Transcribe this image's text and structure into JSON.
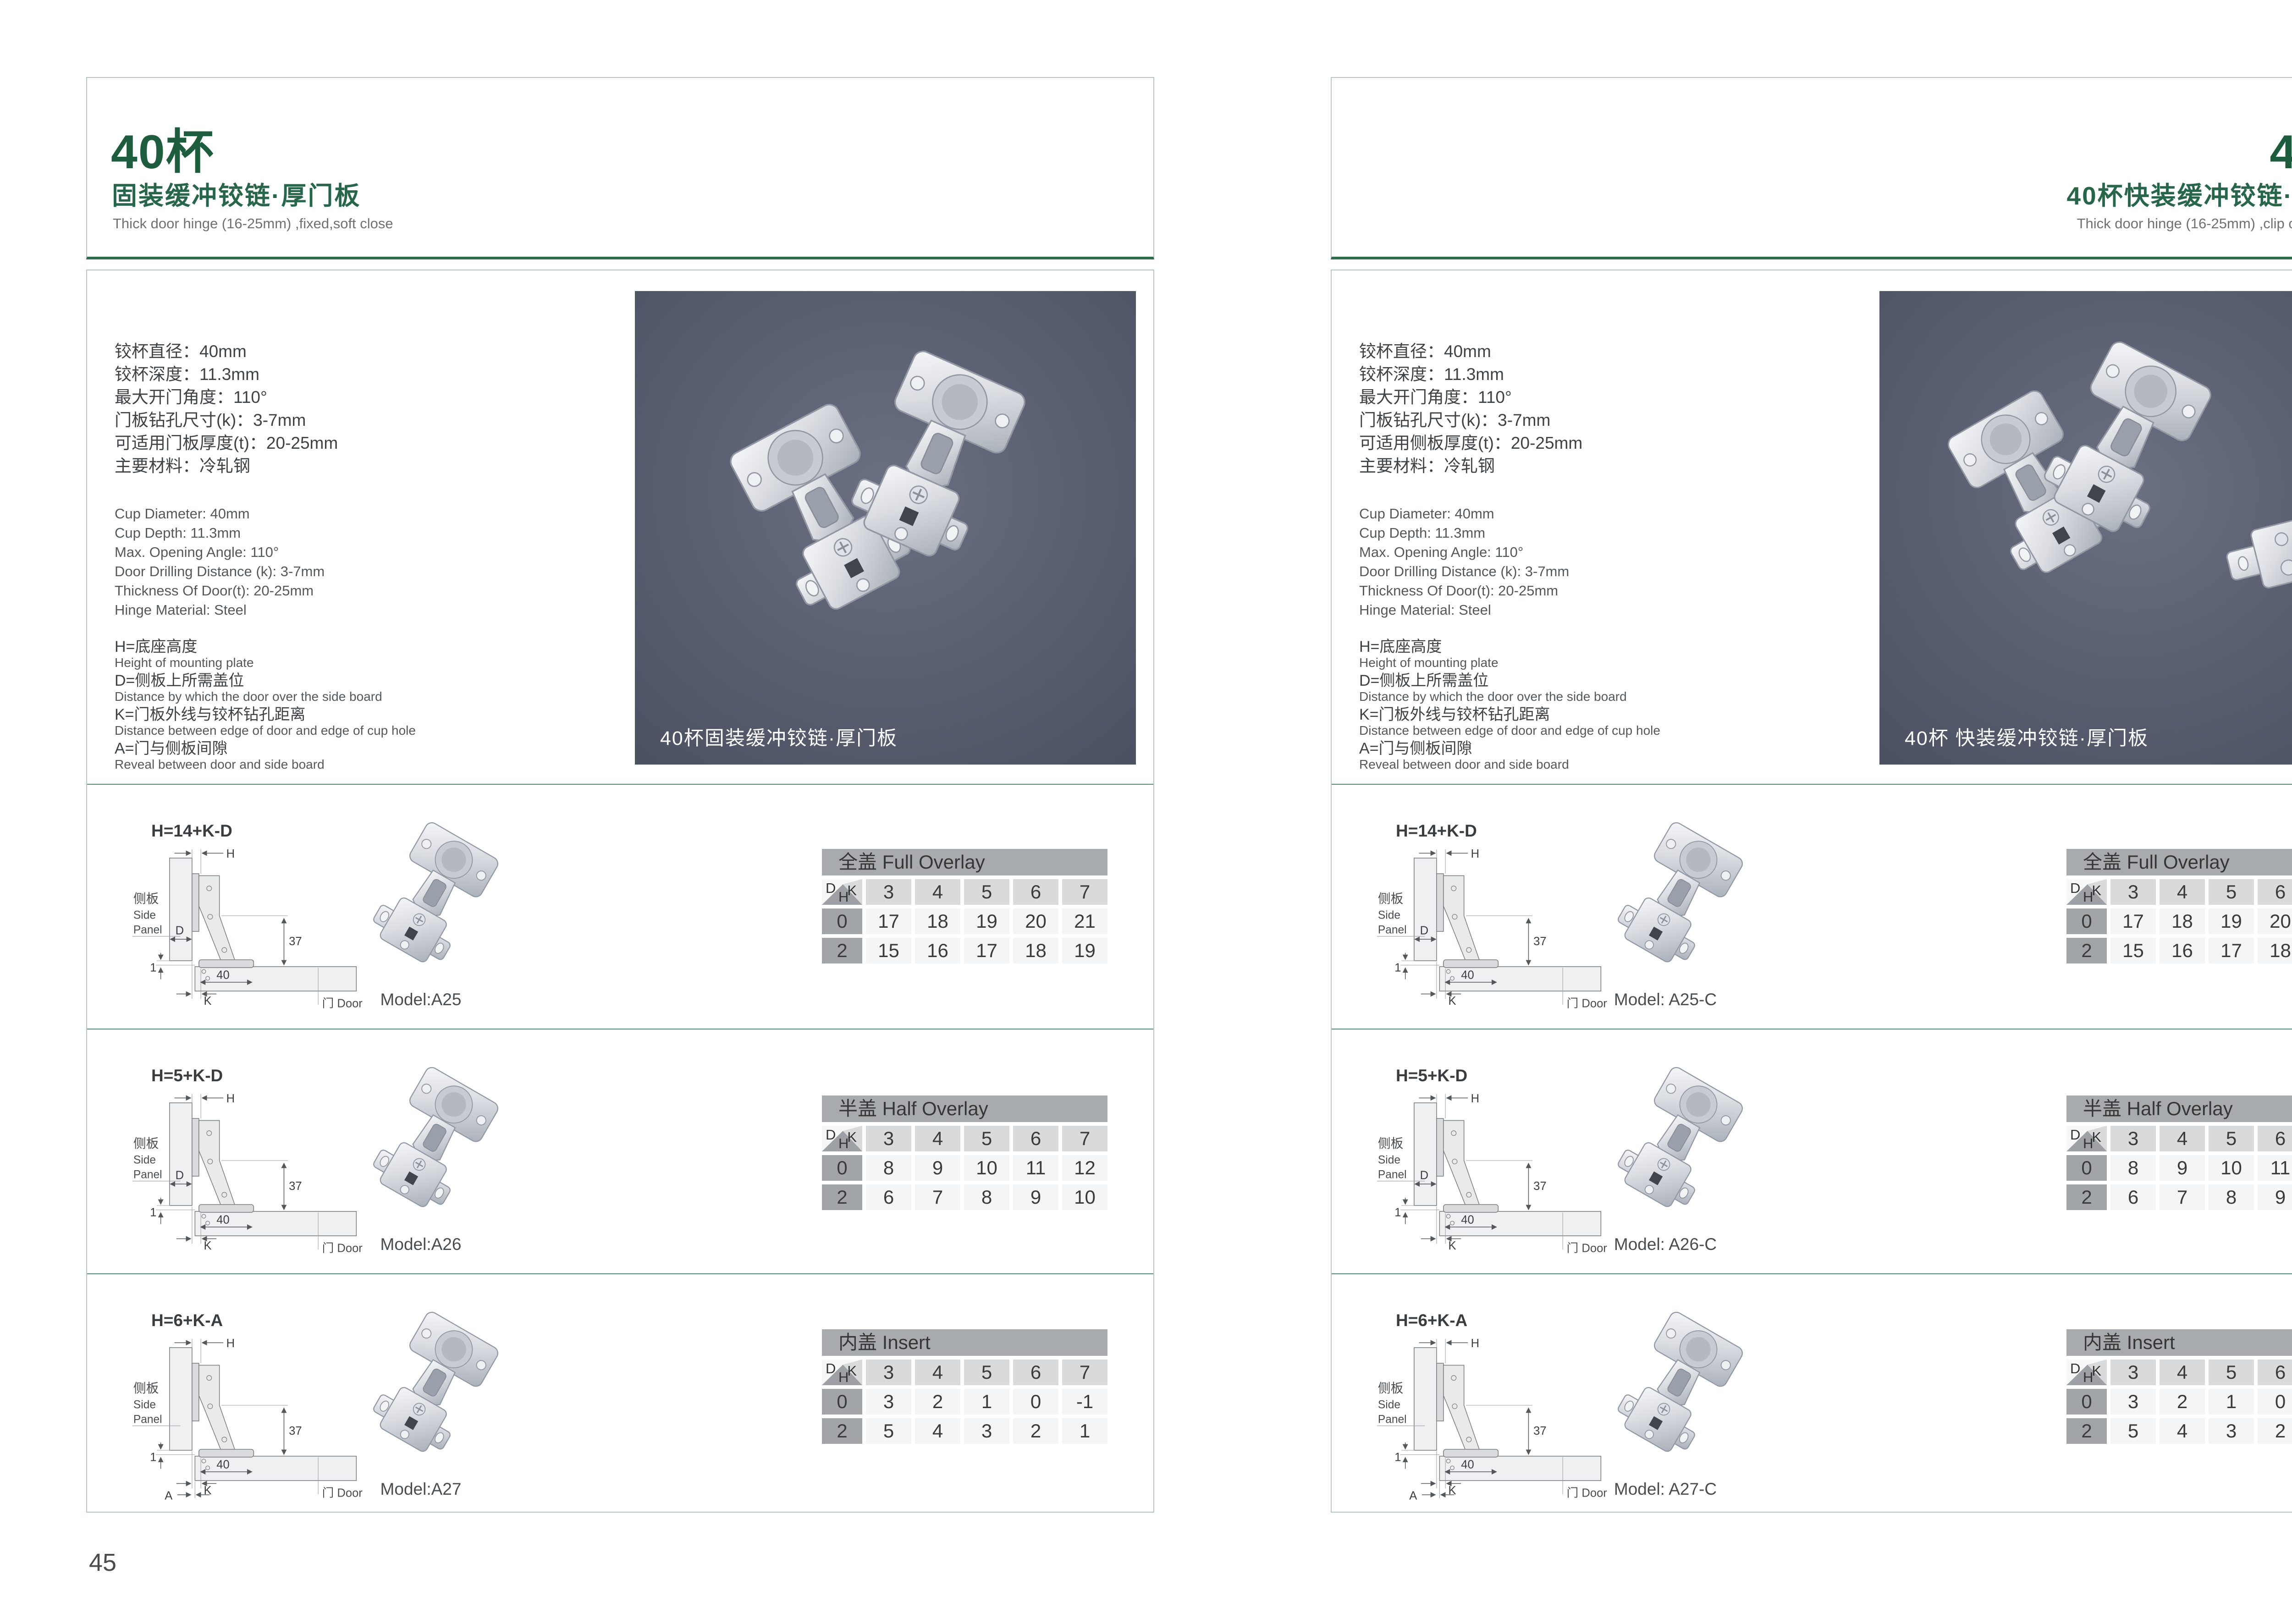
{
  "corner": {
    "d": "D",
    "k": "K",
    "h": "H"
  },
  "diagram": {
    "h": "H",
    "d": "D",
    "k": "K",
    "a": "A",
    "one": "1",
    "forty": "40",
    "thirtyseven": "37",
    "panel_zh": "侧板",
    "panel_en1": "Side",
    "panel_en2": "Panel",
    "door": "门 Door"
  },
  "colors": {
    "title_green": "#1d5c3c",
    "header_rule_green": "#2e6d4d",
    "box_border": "#b7c7bd",
    "row_separator": "#5a8b70",
    "photo_bg": "#555b6c",
    "table_title_bg": "#a8abae",
    "table_k_bg": "#d8dadb",
    "table_h_bg": "#a2a5a8",
    "table_cell_bg": "#f4f5f6"
  },
  "pages": [
    {
      "page_number": "45",
      "header": {
        "title": "40杯",
        "subtitle_zh": "固装缓冲铰链·厚门板",
        "subtitle_en": "Thick door hinge (16-25mm) ,fixed,soft close"
      },
      "specs_zh": [
        "铰杯直径：40mm",
        "铰杯深度：11.3mm",
        "最大开门角度：110°",
        "门板钻孔尺寸(k)：3-7mm",
        "可适用门板厚度(t)：20-25mm",
        "主要材料：冷轧钢"
      ],
      "specs_en": [
        "Cup Diameter: 40mm",
        "Cup Depth: 11.3mm",
        "Max. Opening Angle: 110°",
        "Door Drilling Distance (k): 3-7mm",
        "Thickness Of Door(t): 20-25mm",
        "Hinge Material: Steel"
      ],
      "legend": [
        {
          "zh": "H=底座高度",
          "en": "Height of mounting plate"
        },
        {
          "zh": "D=侧板上所需盖位",
          "en": "Distance by which the door over the side board"
        },
        {
          "zh": "K=门板外线与铰杯钻孔距离",
          "en": "Distance between edge of door and edge of cup hole"
        },
        {
          "zh": "A=门与侧板间隙",
          "en": "Reveal between door and side board"
        }
      ],
      "photo_caption": "40杯固装缓冲铰链·厚门板",
      "rows": [
        {
          "formula": "H=14+K-D",
          "variant": "d",
          "model": "Model:A25",
          "table": {
            "title": "全盖 Full Overlay",
            "k": [
              "3",
              "4",
              "5",
              "6",
              "7"
            ],
            "body": [
              {
                "h": "0",
                "v": [
                  "17",
                  "18",
                  "19",
                  "20",
                  "21"
                ]
              },
              {
                "h": "2",
                "v": [
                  "15",
                  "16",
                  "17",
                  "18",
                  "19"
                ]
              }
            ]
          }
        },
        {
          "formula": "H=5+K-D",
          "variant": "d",
          "model": "Model:A26",
          "table": {
            "title": "半盖 Half Overlay",
            "k": [
              "3",
              "4",
              "5",
              "6",
              "7"
            ],
            "body": [
              {
                "h": "0",
                "v": [
                  "8",
                  "9",
                  "10",
                  "11",
                  "12"
                ]
              },
              {
                "h": "2",
                "v": [
                  "6",
                  "7",
                  "8",
                  "9",
                  "10"
                ]
              }
            ]
          }
        },
        {
          "formula": "H=6+K-A",
          "variant": "a",
          "model": "Model:A27",
          "table": {
            "title": "内盖 Insert",
            "k": [
              "3",
              "4",
              "5",
              "6",
              "7"
            ],
            "body": [
              {
                "h": "0",
                "v": [
                  "3",
                  "2",
                  "1",
                  "0",
                  "-1"
                ]
              },
              {
                "h": "2",
                "v": [
                  "5",
                  "4",
                  "3",
                  "2",
                  "1"
                ]
              }
            ]
          }
        }
      ]
    },
    {
      "page_number": "46",
      "header": {
        "title": "40杯",
        "subtitle_zh": "40杯快装缓冲铰链·厚门板",
        "subtitle_en": "Thick door hinge (16-25mm) ,clip on ,soft close"
      },
      "specs_zh": [
        "铰杯直径：40mm",
        "铰杯深度：11.3mm",
        "最大开门角度：110°",
        "门板钻孔尺寸(k)：3-7mm",
        "可适用侧板厚度(t)：20-25mm",
        "主要材料：冷轧钢"
      ],
      "specs_en": [
        "Cup Diameter: 40mm",
        "Cup Depth: 11.3mm",
        "Max. Opening Angle: 110°",
        "Door Drilling Distance (k): 3-7mm",
        "Thickness Of Door(t): 20-25mm",
        "Hinge Material: Steel"
      ],
      "legend": [
        {
          "zh": "H=底座高度",
          "en": "Height of mounting plate"
        },
        {
          "zh": "D=侧板上所需盖位",
          "en": "Distance by which the door over the side board"
        },
        {
          "zh": "K=门板外线与铰杯钻孔距离",
          "en": "Distance between edge of door and edge of cup hole"
        },
        {
          "zh": "A=门与侧板间隙",
          "en": "Reveal between door and side board"
        }
      ],
      "photo_caption": "40杯 快装缓冲铰链·厚门板",
      "rows": [
        {
          "formula": "H=14+K-D",
          "variant": "d",
          "model": "Model: A25-C",
          "table": {
            "title": "全盖 Full Overlay",
            "k": [
              "3",
              "4",
              "5",
              "6",
              "7"
            ],
            "body": [
              {
                "h": "0",
                "v": [
                  "17",
                  "18",
                  "19",
                  "20",
                  "21"
                ]
              },
              {
                "h": "2",
                "v": [
                  "15",
                  "16",
                  "17",
                  "18",
                  "19"
                ]
              }
            ]
          }
        },
        {
          "formula": "H=5+K-D",
          "variant": "d",
          "model": "Model: A26-C",
          "table": {
            "title": "半盖 Half Overlay",
            "k": [
              "3",
              "4",
              "5",
              "6",
              "7"
            ],
            "body": [
              {
                "h": "0",
                "v": [
                  "8",
                  "9",
                  "10",
                  "11",
                  "12"
                ]
              },
              {
                "h": "2",
                "v": [
                  "6",
                  "7",
                  "8",
                  "9",
                  "10"
                ]
              }
            ]
          }
        },
        {
          "formula": "H=6+K-A",
          "variant": "a",
          "model": "Model: A27-C",
          "table": {
            "title": "内盖 Insert",
            "k": [
              "3",
              "4",
              "5",
              "6",
              "7"
            ],
            "body": [
              {
                "h": "0",
                "v": [
                  "3",
                  "2",
                  "1",
                  "0",
                  "-1"
                ]
              },
              {
                "h": "2",
                "v": [
                  "5",
                  "4",
                  "3",
                  "2",
                  "1"
                ]
              }
            ]
          }
        }
      ]
    }
  ]
}
